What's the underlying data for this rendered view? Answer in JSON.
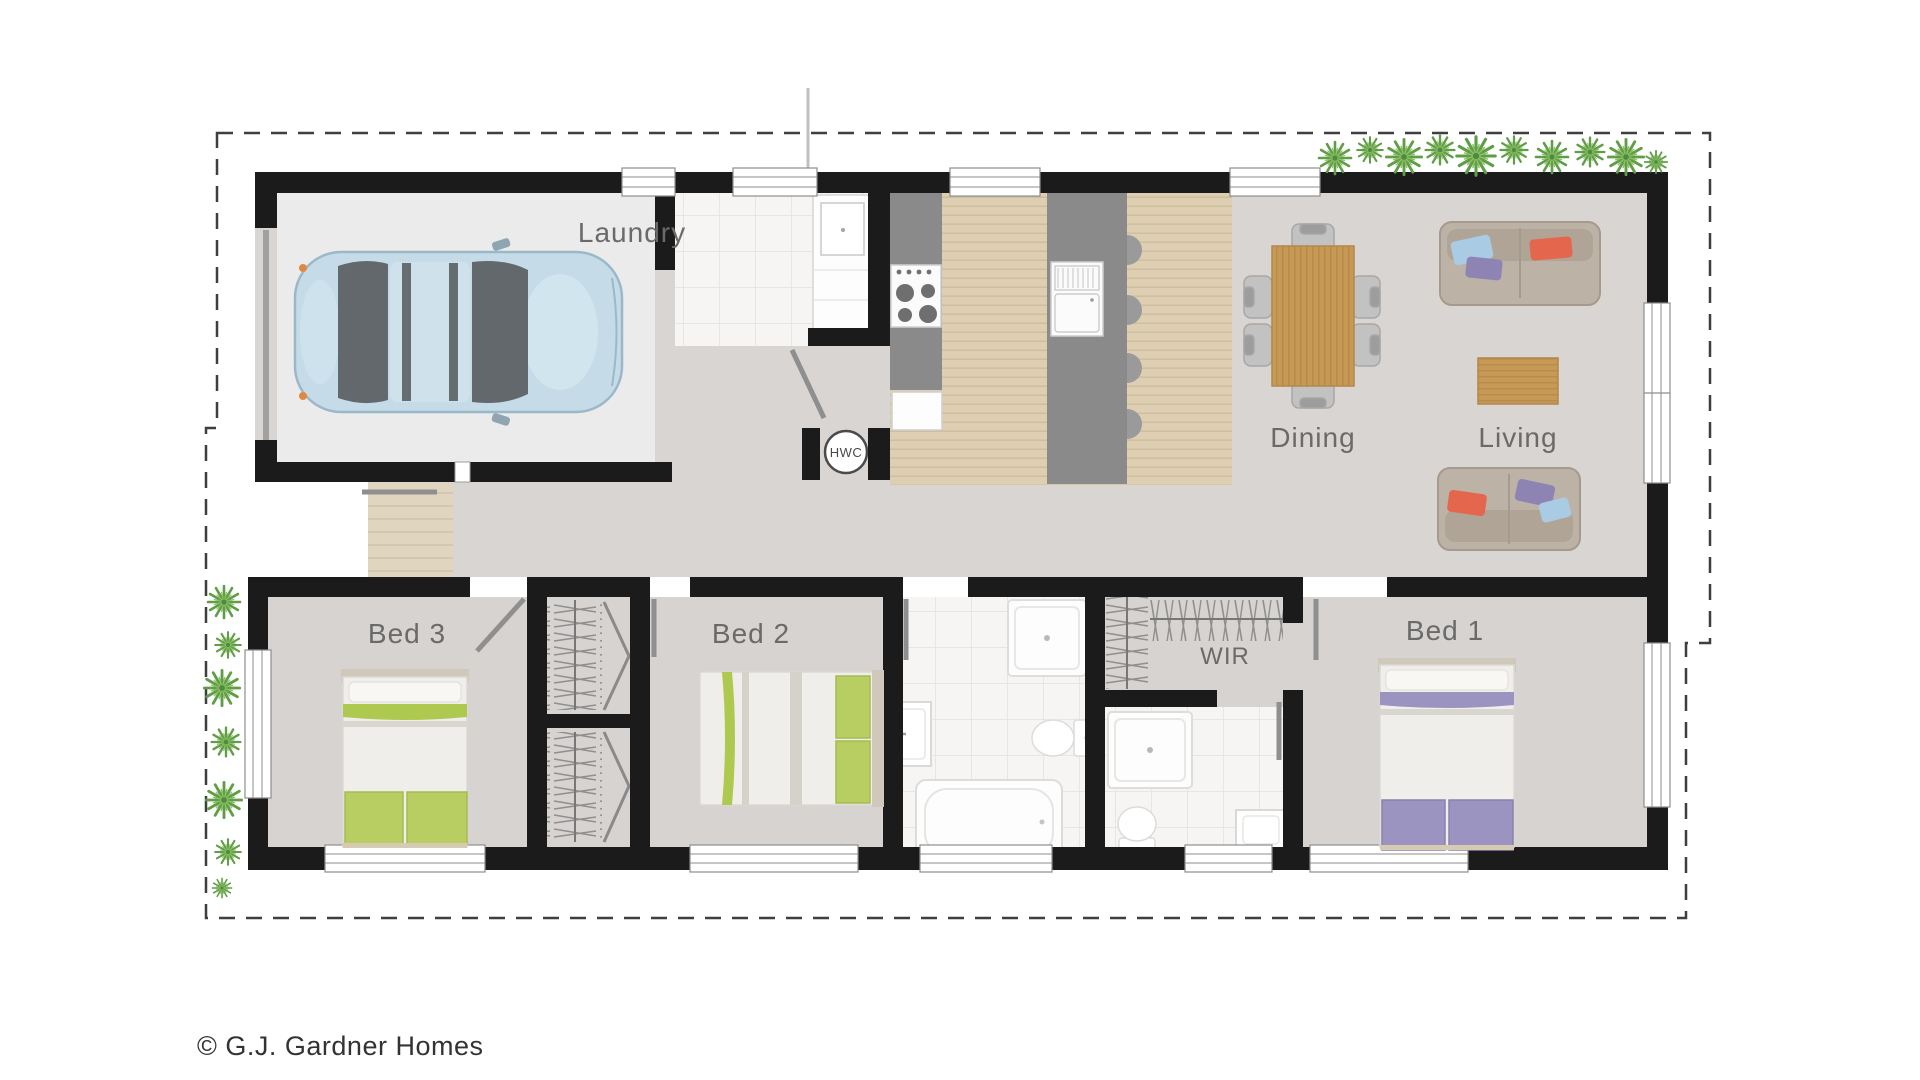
{
  "copyright": "© G.J. Gardner Homes",
  "plan": {
    "type": "single-storey-house-floor-plan",
    "brand": "G.J. Gardner Homes",
    "labels": {
      "laundry": "Laundry",
      "dining": "Dining",
      "living": "Living",
      "bed1": "Bed 1",
      "bed2": "Bed 2",
      "bed3": "Bed 3",
      "wir": "WIR",
      "hwc": "HWC"
    },
    "rooms": [
      {
        "id": "garage",
        "label": "",
        "features": [
          "car"
        ]
      },
      {
        "id": "laundry",
        "label": "Laundry",
        "features": [
          "laundry-tub"
        ]
      },
      {
        "id": "kitchen",
        "label": "",
        "features": [
          "cooktop",
          "bench",
          "island-bench",
          "fridge",
          "bar-stools"
        ]
      },
      {
        "id": "dining",
        "label": "Dining",
        "features": [
          "dining-table",
          "six-chairs"
        ]
      },
      {
        "id": "living",
        "label": "Living",
        "features": [
          "sofa",
          "sofa",
          "coffee-table"
        ]
      },
      {
        "id": "entry",
        "label": "",
        "features": [
          "porch",
          "front-door"
        ]
      },
      {
        "id": "bed3",
        "label": "Bed 3",
        "features": [
          "bed-green",
          "wardrobe-bifold"
        ]
      },
      {
        "id": "bed2",
        "label": "Bed 2",
        "features": [
          "bed-green",
          "wardrobe-bifold"
        ]
      },
      {
        "id": "bathroom",
        "label": "",
        "features": [
          "shower",
          "vanity",
          "toilet",
          "bath"
        ]
      },
      {
        "id": "wir",
        "label": "WIR",
        "features": [
          "clothes-rails"
        ]
      },
      {
        "id": "ensuite",
        "label": "",
        "features": [
          "shower",
          "toilet",
          "vanity"
        ]
      },
      {
        "id": "bed1",
        "label": "Bed 1",
        "features": [
          "bed-purple"
        ]
      },
      {
        "id": "hwc",
        "label": "HWC",
        "features": [
          "hot-water-cylinder"
        ]
      }
    ],
    "colors": {
      "wall": "#1b1b1b",
      "boundary": "#3f3f3f",
      "floor": "#d9d5d2",
      "garage_floor": "#ebebeb",
      "timber_floor": "#decfb2",
      "tile_floor": "#f6f5f3",
      "porch": "#e0d6c0",
      "bench": "#8a8a8a",
      "table_wood": "#c69a55",
      "sofa": "#bdb2a6",
      "bed_green": "#b8cd62",
      "bed_purple": "#9b93c0",
      "car": "#c5dce8",
      "plant": "#5e9e44",
      "label_text": "#6a6a6a",
      "copyright_text": "#333333"
    }
  }
}
